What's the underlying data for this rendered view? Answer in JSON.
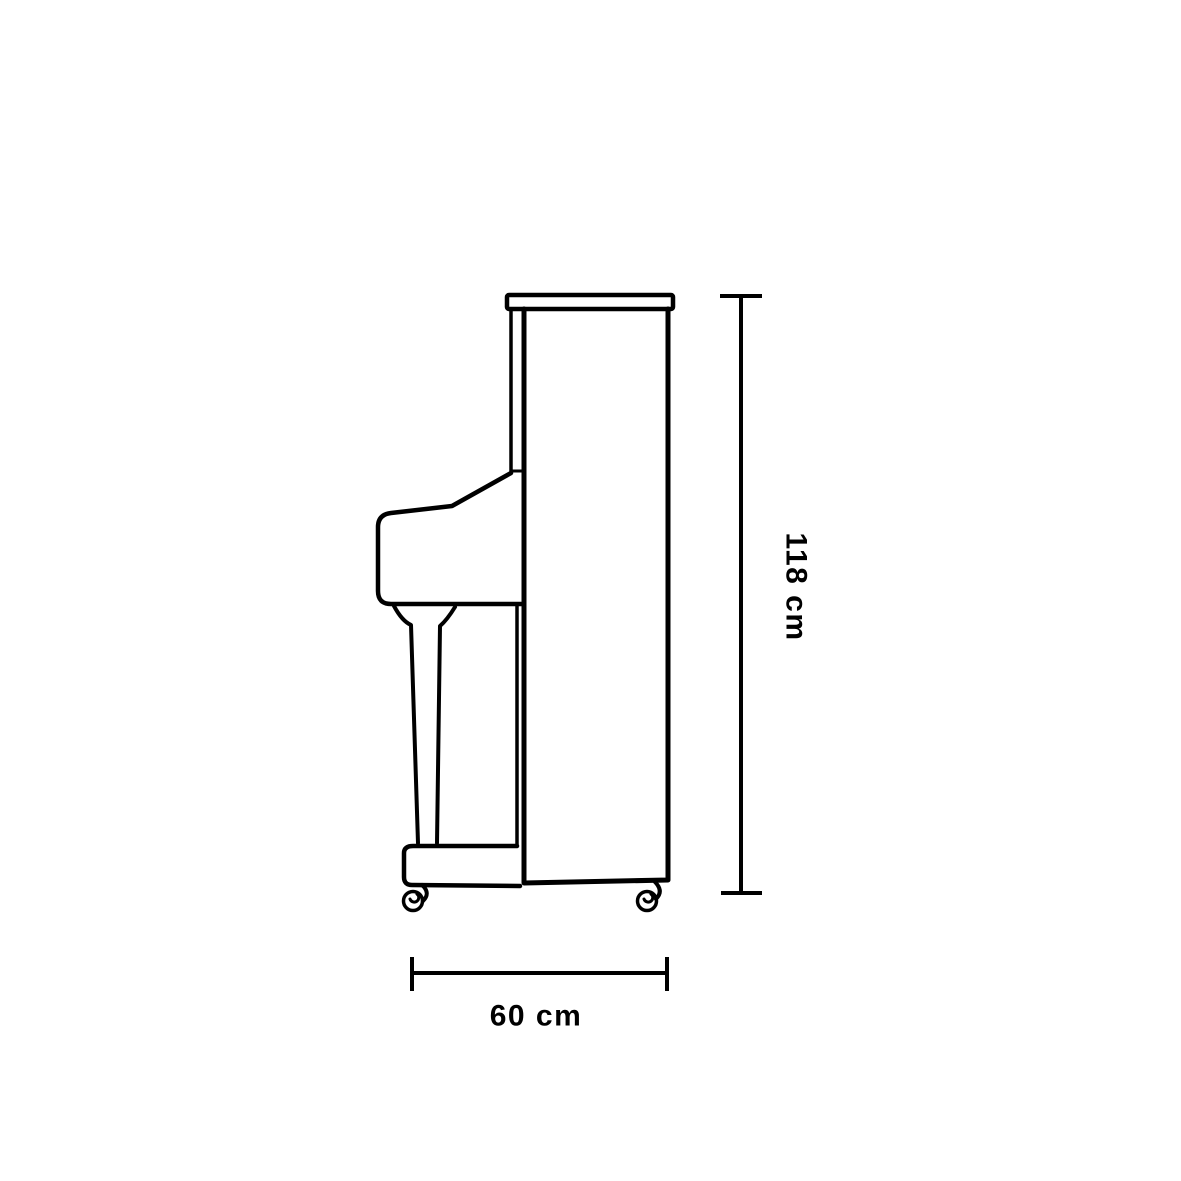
{
  "canvas": {
    "background": "#ffffff",
    "line_color": "#000000",
    "text_color": "#000000"
  },
  "figure": {
    "subject": "upright-piano-side-view-line-drawing"
  },
  "dimensions": {
    "height": {
      "label": "118 cm",
      "value": 118,
      "unit": "cm"
    },
    "depth": {
      "label": "60 cm",
      "value": 60,
      "unit": "cm"
    }
  }
}
